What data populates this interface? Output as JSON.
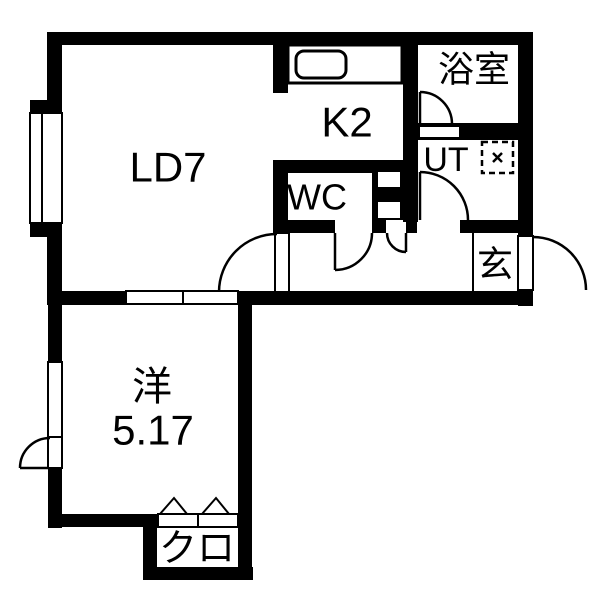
{
  "floorplan": {
    "type": "japanese-apartment-floorplan",
    "colors": {
      "wall": "#000000",
      "floor": "#ffffff"
    },
    "rooms": {
      "living_dining": {
        "label": "LD7"
      },
      "kitchen": {
        "label": "K2"
      },
      "bathroom": {
        "label": "浴室"
      },
      "utility": {
        "label": "UT"
      },
      "toilet": {
        "label": "WC"
      },
      "entrance": {
        "label": "玄"
      },
      "western_room": {
        "name": "洋",
        "size": "5.17"
      },
      "closet": {
        "label": "クロ"
      }
    },
    "icons": {
      "kitchen_sink": "rounded-rect-outline",
      "washing_machine_pan": "dashed-square-with-x",
      "bifold_door_marker": "open-triangle-chevrons",
      "door_swing": "quarter-circle-arc",
      "sliding_door": "paired-white-panels",
      "window": "double-sash-rect"
    }
  }
}
